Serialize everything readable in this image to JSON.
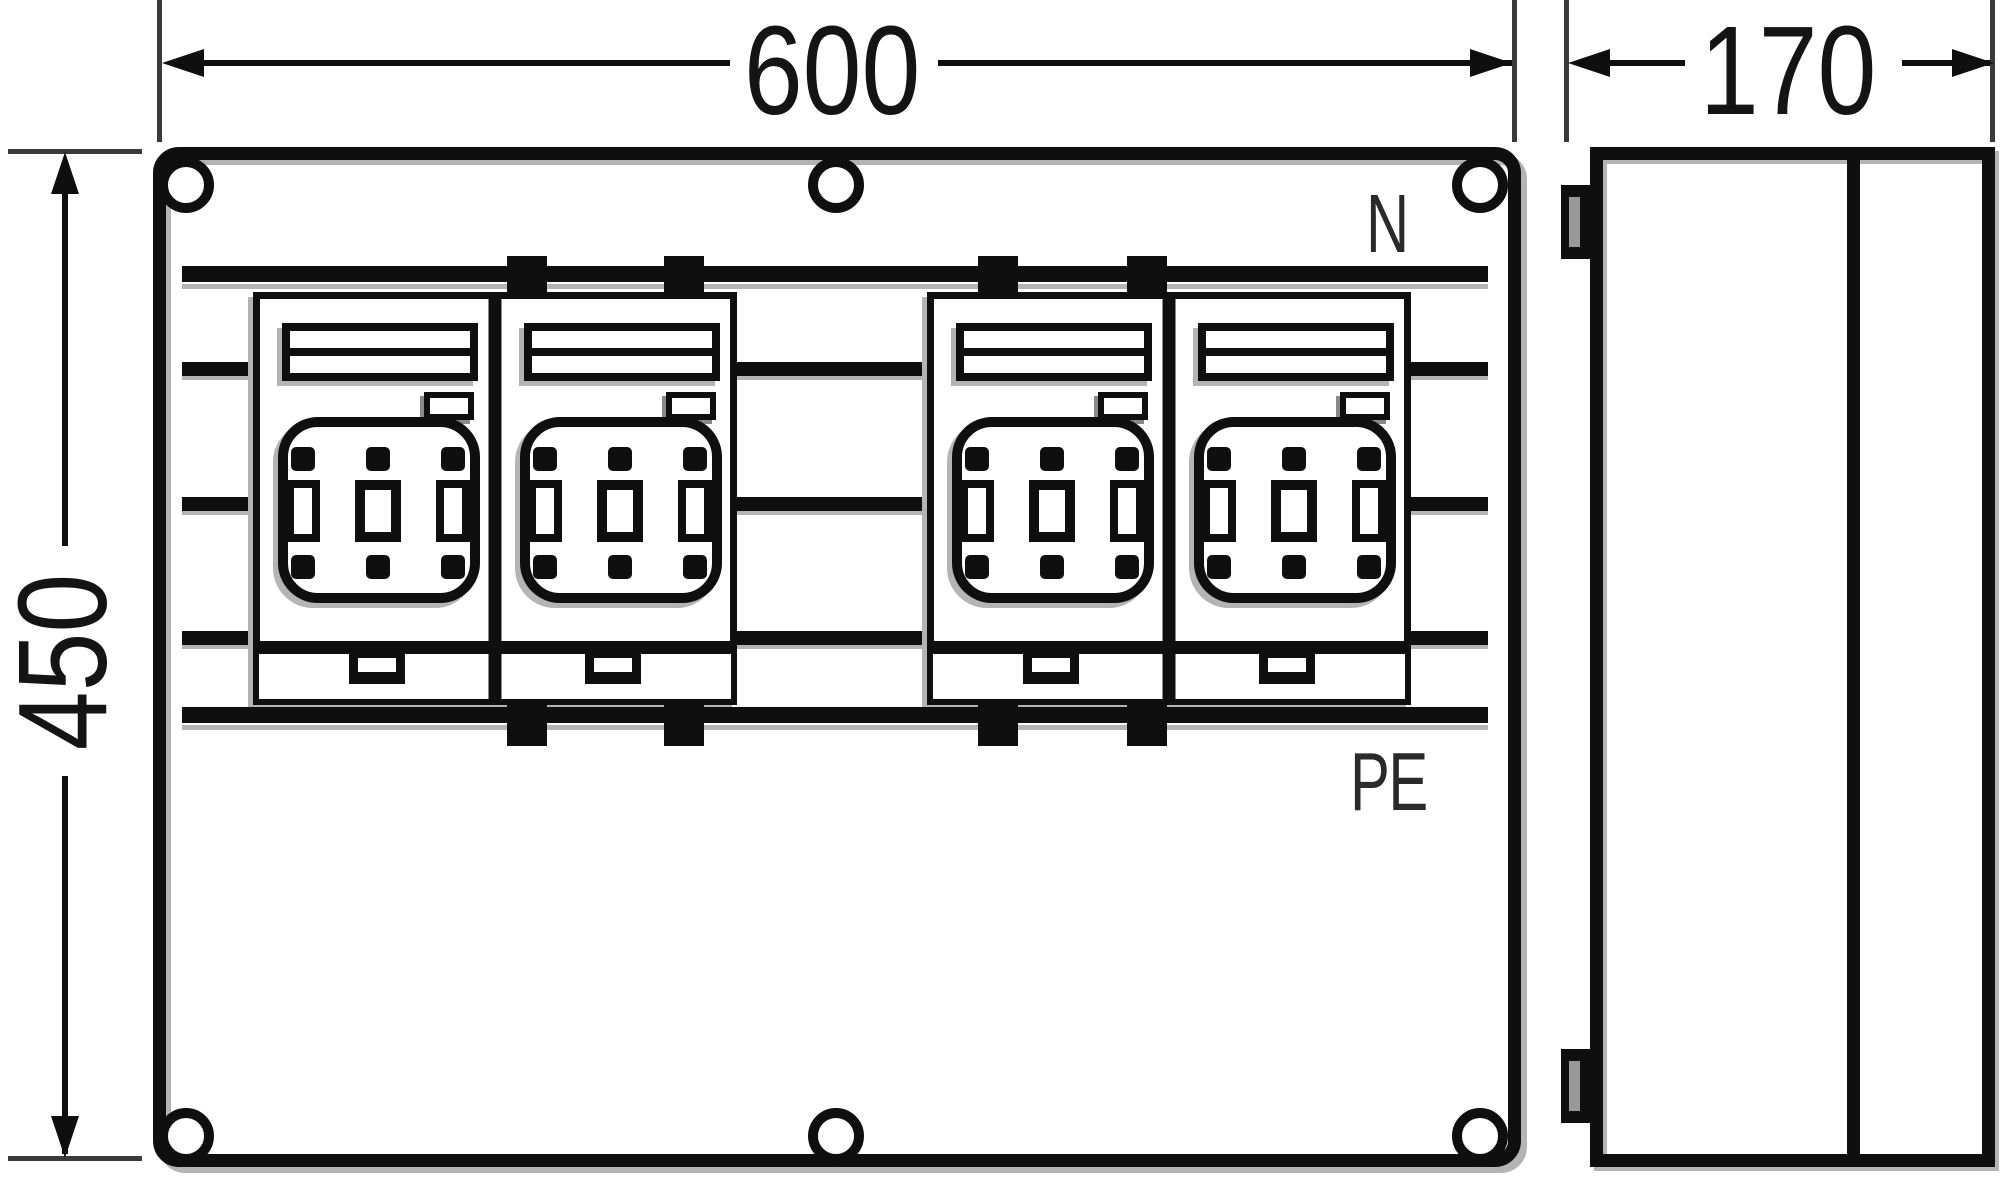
{
  "drawing": {
    "title_dimensions": {
      "width_mm": "600",
      "height_mm": "450",
      "depth_mm": "170"
    },
    "busbar_labels": {
      "neutral": "N",
      "protective_earth": "PE"
    },
    "components": {
      "fuse_switch_units": 4,
      "mounting_holes": 6,
      "hinges": 2
    },
    "colors": {
      "line": "#0f0f0f",
      "shadow": "#b4b4b4",
      "background": "#ffffff"
    }
  }
}
